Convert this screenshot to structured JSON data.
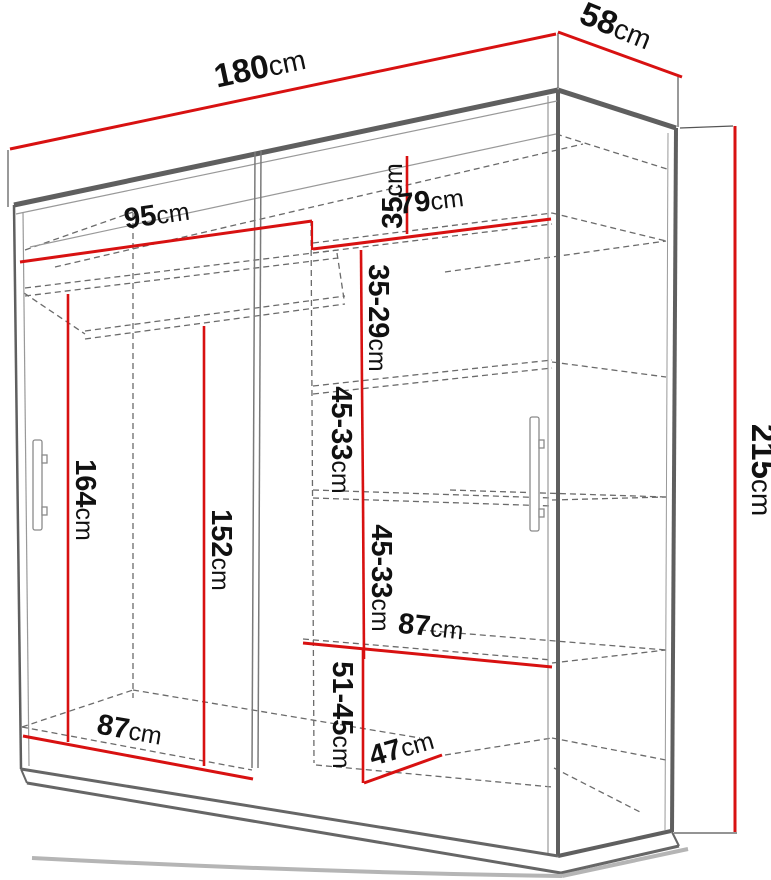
{
  "diagram": {
    "subject": "sliding-door wardrobe with dimension annotations",
    "colors": {
      "dimension_line": "#d81111",
      "carcass_line": "#5f5f5f",
      "thin_line": "#999999",
      "dashed_line": "#6b6b6b",
      "label_text": "#111111",
      "background": "#ffffff"
    },
    "dims": [
      {
        "id": "overall-width",
        "value": "180",
        "unit": "cm"
      },
      {
        "id": "overall-depth",
        "value": "58",
        "unit": "cm"
      },
      {
        "id": "overall-height",
        "value": "215",
        "unit": "cm"
      },
      {
        "id": "left-section-width",
        "value": "95",
        "unit": "cm"
      },
      {
        "id": "right-section-width",
        "value": "79",
        "unit": "cm"
      },
      {
        "id": "top-shelf-gap",
        "value": "35",
        "unit": "cm"
      },
      {
        "id": "shelf-gap-upper",
        "value": "35-29",
        "unit": "cm"
      },
      {
        "id": "rod-clear-height",
        "value": "164",
        "unit": "cm"
      },
      {
        "id": "inner-height",
        "value": "152",
        "unit": "cm"
      },
      {
        "id": "shelf-gap-mid-1",
        "value": "45-33",
        "unit": "cm"
      },
      {
        "id": "shelf-gap-mid-2",
        "value": "45-33",
        "unit": "cm"
      },
      {
        "id": "right-shelf-width",
        "value": "87",
        "unit": "cm"
      },
      {
        "id": "left-bottom-width",
        "value": "87",
        "unit": "cm"
      },
      {
        "id": "bottom-shelf-gap",
        "value": "51-45",
        "unit": "cm"
      },
      {
        "id": "bottom-depth",
        "value": "47",
        "unit": "cm"
      }
    ]
  }
}
